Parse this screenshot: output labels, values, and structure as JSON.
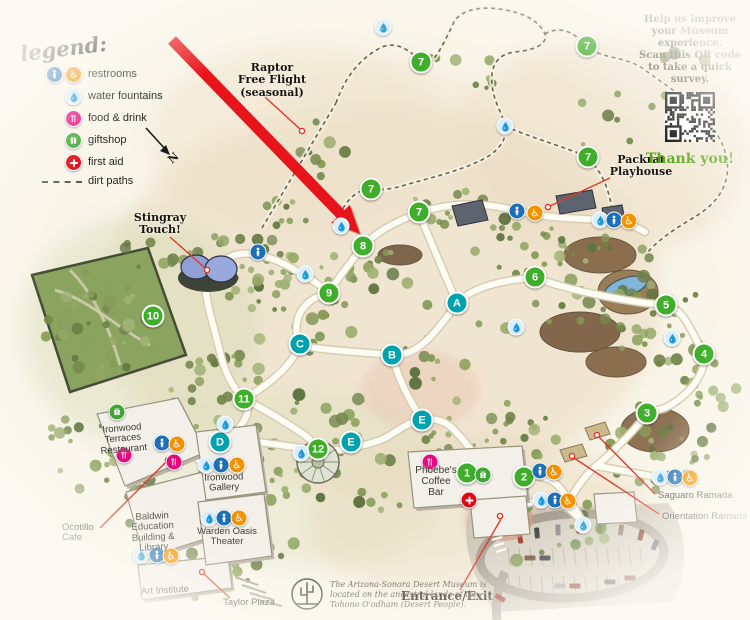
{
  "legend": {
    "title": "legend:",
    "items": [
      {
        "type": "restrooms",
        "label": "restrooms"
      },
      {
        "type": "water",
        "label": "water fountains"
      },
      {
        "type": "food",
        "label": "food & drink"
      },
      {
        "type": "gift",
        "label": "giftshop"
      },
      {
        "type": "firstaid",
        "label": "first aid"
      },
      {
        "type": "dirt",
        "label": "dirt paths"
      }
    ]
  },
  "north_label": "N",
  "survey": {
    "line1": "Help us improve your Museum experience.",
    "line2": "Scan this QR code to take a quick survey.",
    "thanks": "Thank you!"
  },
  "attribution": {
    "lines": [
      "The Arizona-Sonora Desert Museum is",
      "located on the ancestral lands of the",
      "Tohono O'odham (Desert People)."
    ]
  },
  "callouts": {
    "raptor": {
      "lines": [
        "Raptor",
        "Free Flight",
        "(seasonal)"
      ]
    },
    "packrat": {
      "lines": [
        "Packrat",
        "Playhouse"
      ]
    },
    "stingray": {
      "lines": [
        "Stingray",
        "Touch!"
      ]
    },
    "entrance": {
      "lines": [
        "Entrance/Exit"
      ]
    },
    "ocotillo": {
      "lines": [
        "Ocotillo",
        "Cafe"
      ]
    },
    "taylor": {
      "lines": [
        "Taylor Plaza"
      ]
    },
    "saguaro": {
      "lines": [
        "Saguaro Ramada"
      ]
    },
    "orientation": {
      "lines": [
        "Orientation Ramada"
      ]
    }
  },
  "buildings": {
    "ironwood_terraces": {
      "lines": [
        "Ironwood",
        "Terraces",
        "Restaurant"
      ]
    },
    "baldwin": {
      "lines": [
        "Baldwin",
        "Education",
        "Building &",
        "Library"
      ]
    },
    "art_institute": {
      "lines": [
        "Art Institute"
      ]
    },
    "ironwood_gallery": {
      "lines": [
        "Ironwood",
        "Gallery"
      ]
    },
    "warden_oasis": {
      "lines": [
        "Warden Oasis",
        "Theater"
      ]
    },
    "phoebes": {
      "lines": [
        "Phoebe's",
        "Coffee",
        "Bar"
      ]
    }
  },
  "markers": {
    "numbered": [
      {
        "label": "1",
        "x": 467,
        "y": 473
      },
      {
        "label": "2",
        "x": 524,
        "y": 477
      },
      {
        "label": "3",
        "x": 647,
        "y": 413
      },
      {
        "label": "4",
        "x": 704,
        "y": 354
      },
      {
        "label": "5",
        "x": 666,
        "y": 305
      },
      {
        "label": "6",
        "x": 535,
        "y": 277
      },
      {
        "label": "7",
        "x": 587,
        "y": 46
      },
      {
        "label": "7",
        "x": 421,
        "y": 62
      },
      {
        "label": "7",
        "x": 588,
        "y": 157
      },
      {
        "label": "7",
        "x": 371,
        "y": 189
      },
      {
        "label": "7",
        "x": 419,
        "y": 212
      },
      {
        "label": "8",
        "x": 363,
        "y": 246
      },
      {
        "label": "9",
        "x": 329,
        "y": 293
      },
      {
        "label": "10",
        "x": 153,
        "y": 316
      },
      {
        "label": "11",
        "x": 244,
        "y": 399
      },
      {
        "label": "12",
        "x": 318,
        "y": 449
      }
    ],
    "lettered": [
      {
        "label": "A",
        "x": 457,
        "y": 303
      },
      {
        "label": "B",
        "x": 392,
        "y": 355
      },
      {
        "label": "C",
        "x": 300,
        "y": 344
      },
      {
        "label": "D",
        "x": 220,
        "y": 442
      },
      {
        "label": "E",
        "x": 422,
        "y": 420
      },
      {
        "label": "E",
        "x": 351,
        "y": 442
      }
    ],
    "amenities": [
      {
        "type": "water",
        "x": 383,
        "y": 27
      },
      {
        "type": "water",
        "x": 505,
        "y": 126
      },
      {
        "type": "water",
        "x": 341,
        "y": 226
      },
      {
        "type": "water",
        "x": 305,
        "y": 274
      },
      {
        "type": "water",
        "x": 516,
        "y": 327
      },
      {
        "type": "water",
        "x": 672,
        "y": 338
      },
      {
        "type": "water",
        "x": 660,
        "y": 477
      },
      {
        "type": "water",
        "x": 600,
        "y": 220
      },
      {
        "type": "water",
        "x": 225,
        "y": 424
      },
      {
        "type": "water",
        "x": 206,
        "y": 465
      },
      {
        "type": "water",
        "x": 209,
        "y": 518
      },
      {
        "type": "water",
        "x": 141,
        "y": 555
      },
      {
        "type": "water",
        "x": 301,
        "y": 453
      },
      {
        "type": "water",
        "x": 541,
        "y": 500
      },
      {
        "type": "water",
        "x": 583,
        "y": 525
      },
      {
        "type": "restroom",
        "x": 258,
        "y": 252
      },
      {
        "type": "restroom",
        "x": 517,
        "y": 211
      },
      {
        "type": "restroom",
        "x": 614,
        "y": 220
      },
      {
        "type": "restroom",
        "x": 675,
        "y": 477
      },
      {
        "type": "restroom",
        "x": 162,
        "y": 443
      },
      {
        "type": "restroom",
        "x": 221,
        "y": 465
      },
      {
        "type": "restroom",
        "x": 224,
        "y": 518
      },
      {
        "type": "restroom",
        "x": 157,
        "y": 555
      },
      {
        "type": "restroom",
        "x": 540,
        "y": 471
      },
      {
        "type": "restroom",
        "x": 555,
        "y": 500
      },
      {
        "type": "accessible",
        "x": 535,
        "y": 213
      },
      {
        "type": "accessible",
        "x": 629,
        "y": 221
      },
      {
        "type": "accessible",
        "x": 690,
        "y": 478
      },
      {
        "type": "accessible",
        "x": 177,
        "y": 444
      },
      {
        "type": "accessible",
        "x": 237,
        "y": 465
      },
      {
        "type": "accessible",
        "x": 239,
        "y": 518
      },
      {
        "type": "accessible",
        "x": 171,
        "y": 556
      },
      {
        "type": "accessible",
        "x": 554,
        "y": 472
      },
      {
        "type": "accessible",
        "x": 568,
        "y": 501
      },
      {
        "type": "food",
        "x": 124,
        "y": 455
      },
      {
        "type": "food",
        "x": 174,
        "y": 462
      },
      {
        "type": "food",
        "x": 430,
        "y": 462
      },
      {
        "type": "gift",
        "x": 117,
        "y": 412
      },
      {
        "type": "gift",
        "x": 483,
        "y": 475
      },
      {
        "type": "firstaid",
        "x": 469,
        "y": 500
      }
    ]
  },
  "colors": {
    "numbered_green": "#3fae2a",
    "lettered_teal": "#00a3ad",
    "restroom_blue": "#1d70b7",
    "accessible_orange": "#f39200",
    "food_pink": "#e5097f",
    "gift_green": "#3fa535",
    "firstaid_red": "#e30613",
    "water_blue": "#1d9bd8",
    "thanks_green": "#58a618",
    "arrow_red": "#e8141c",
    "leader_red": "#df3a2a"
  }
}
